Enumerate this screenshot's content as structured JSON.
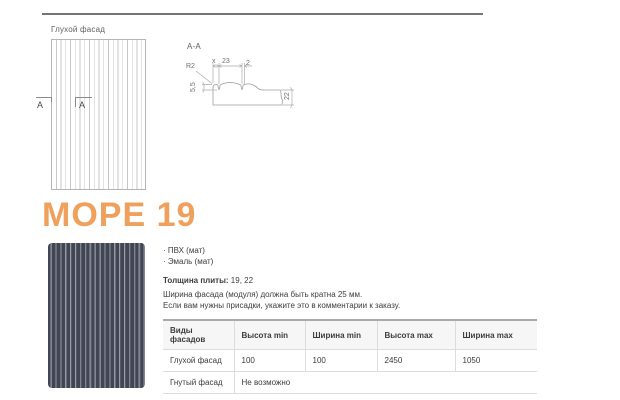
{
  "product": {
    "title": "МОРЕ 19"
  },
  "drawings": {
    "front_label": "Глухой фасад",
    "marker_left": "А",
    "marker_right": "А",
    "section_label": "А-А",
    "dims": {
      "radius": "R2",
      "x": "x",
      "pitch": "23",
      "groove": "2",
      "depth": "5,5",
      "thickness": "22"
    }
  },
  "materials": {
    "items": [
      "· ПВХ (мат)",
      "· Эмаль (мат)"
    ]
  },
  "thickness": {
    "label": "Толщина плиты:",
    "value": " 19, 22"
  },
  "notes": {
    "line1": "Ширина фасада (модуля) должна быть кратна 25 мм.",
    "line2": "Если вам нужны присадки, укажите это в комментарии к заказу."
  },
  "table": {
    "headers": [
      "Виды фасадов",
      "Высота min",
      "Ширина min",
      "Высота max",
      "Ширина max"
    ],
    "rows": [
      {
        "type": "Глухой фасад",
        "height_min": "100",
        "width_min": "100",
        "height_max": "2450",
        "width_max": "1050"
      },
      {
        "type": "Гнутый фасад",
        "note": "Не возможно"
      }
    ]
  },
  "colors": {
    "accent": "#EFA05C",
    "swatch_dark": "#424653",
    "swatch_light": "#9DA2B0",
    "divider": "#757575"
  }
}
